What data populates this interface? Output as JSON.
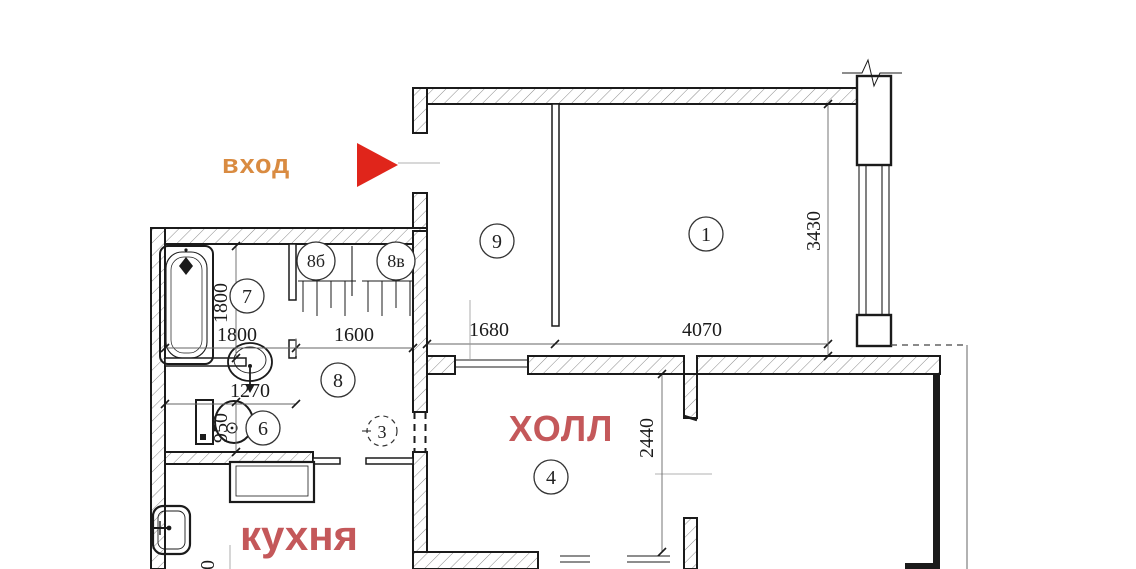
{
  "plan": {
    "entrance_label": "вход",
    "hall_label": "ХОЛЛ",
    "kitchen_label": "кухня",
    "rooms": [
      {
        "id": "room-1",
        "number": "1"
      },
      {
        "id": "room-9",
        "number": "9"
      },
      {
        "id": "room-7",
        "number": "7"
      },
      {
        "id": "room-6",
        "number": "6"
      },
      {
        "id": "room-8",
        "number": "8"
      },
      {
        "id": "closet-8b",
        "number": "8б"
      },
      {
        "id": "closet-8v",
        "number": "8в"
      },
      {
        "id": "room-4",
        "number": "4"
      },
      {
        "id": "door-3",
        "number": "3"
      }
    ],
    "dimensions": {
      "bath_width": "1800",
      "bath_depth": "1800",
      "corridor_width": "1600",
      "toilet_width": "1270",
      "toilet_depth": "950",
      "room9_width": "1680",
      "room1_width": "4070",
      "room1_depth": "3430",
      "hall_depth": "2440",
      "kitchen_partial": "0"
    },
    "colors": {
      "entrance": "#d98b41",
      "arrow": "#e0251b",
      "room_label": "#c4585a",
      "line": "#1b1b1b"
    }
  }
}
